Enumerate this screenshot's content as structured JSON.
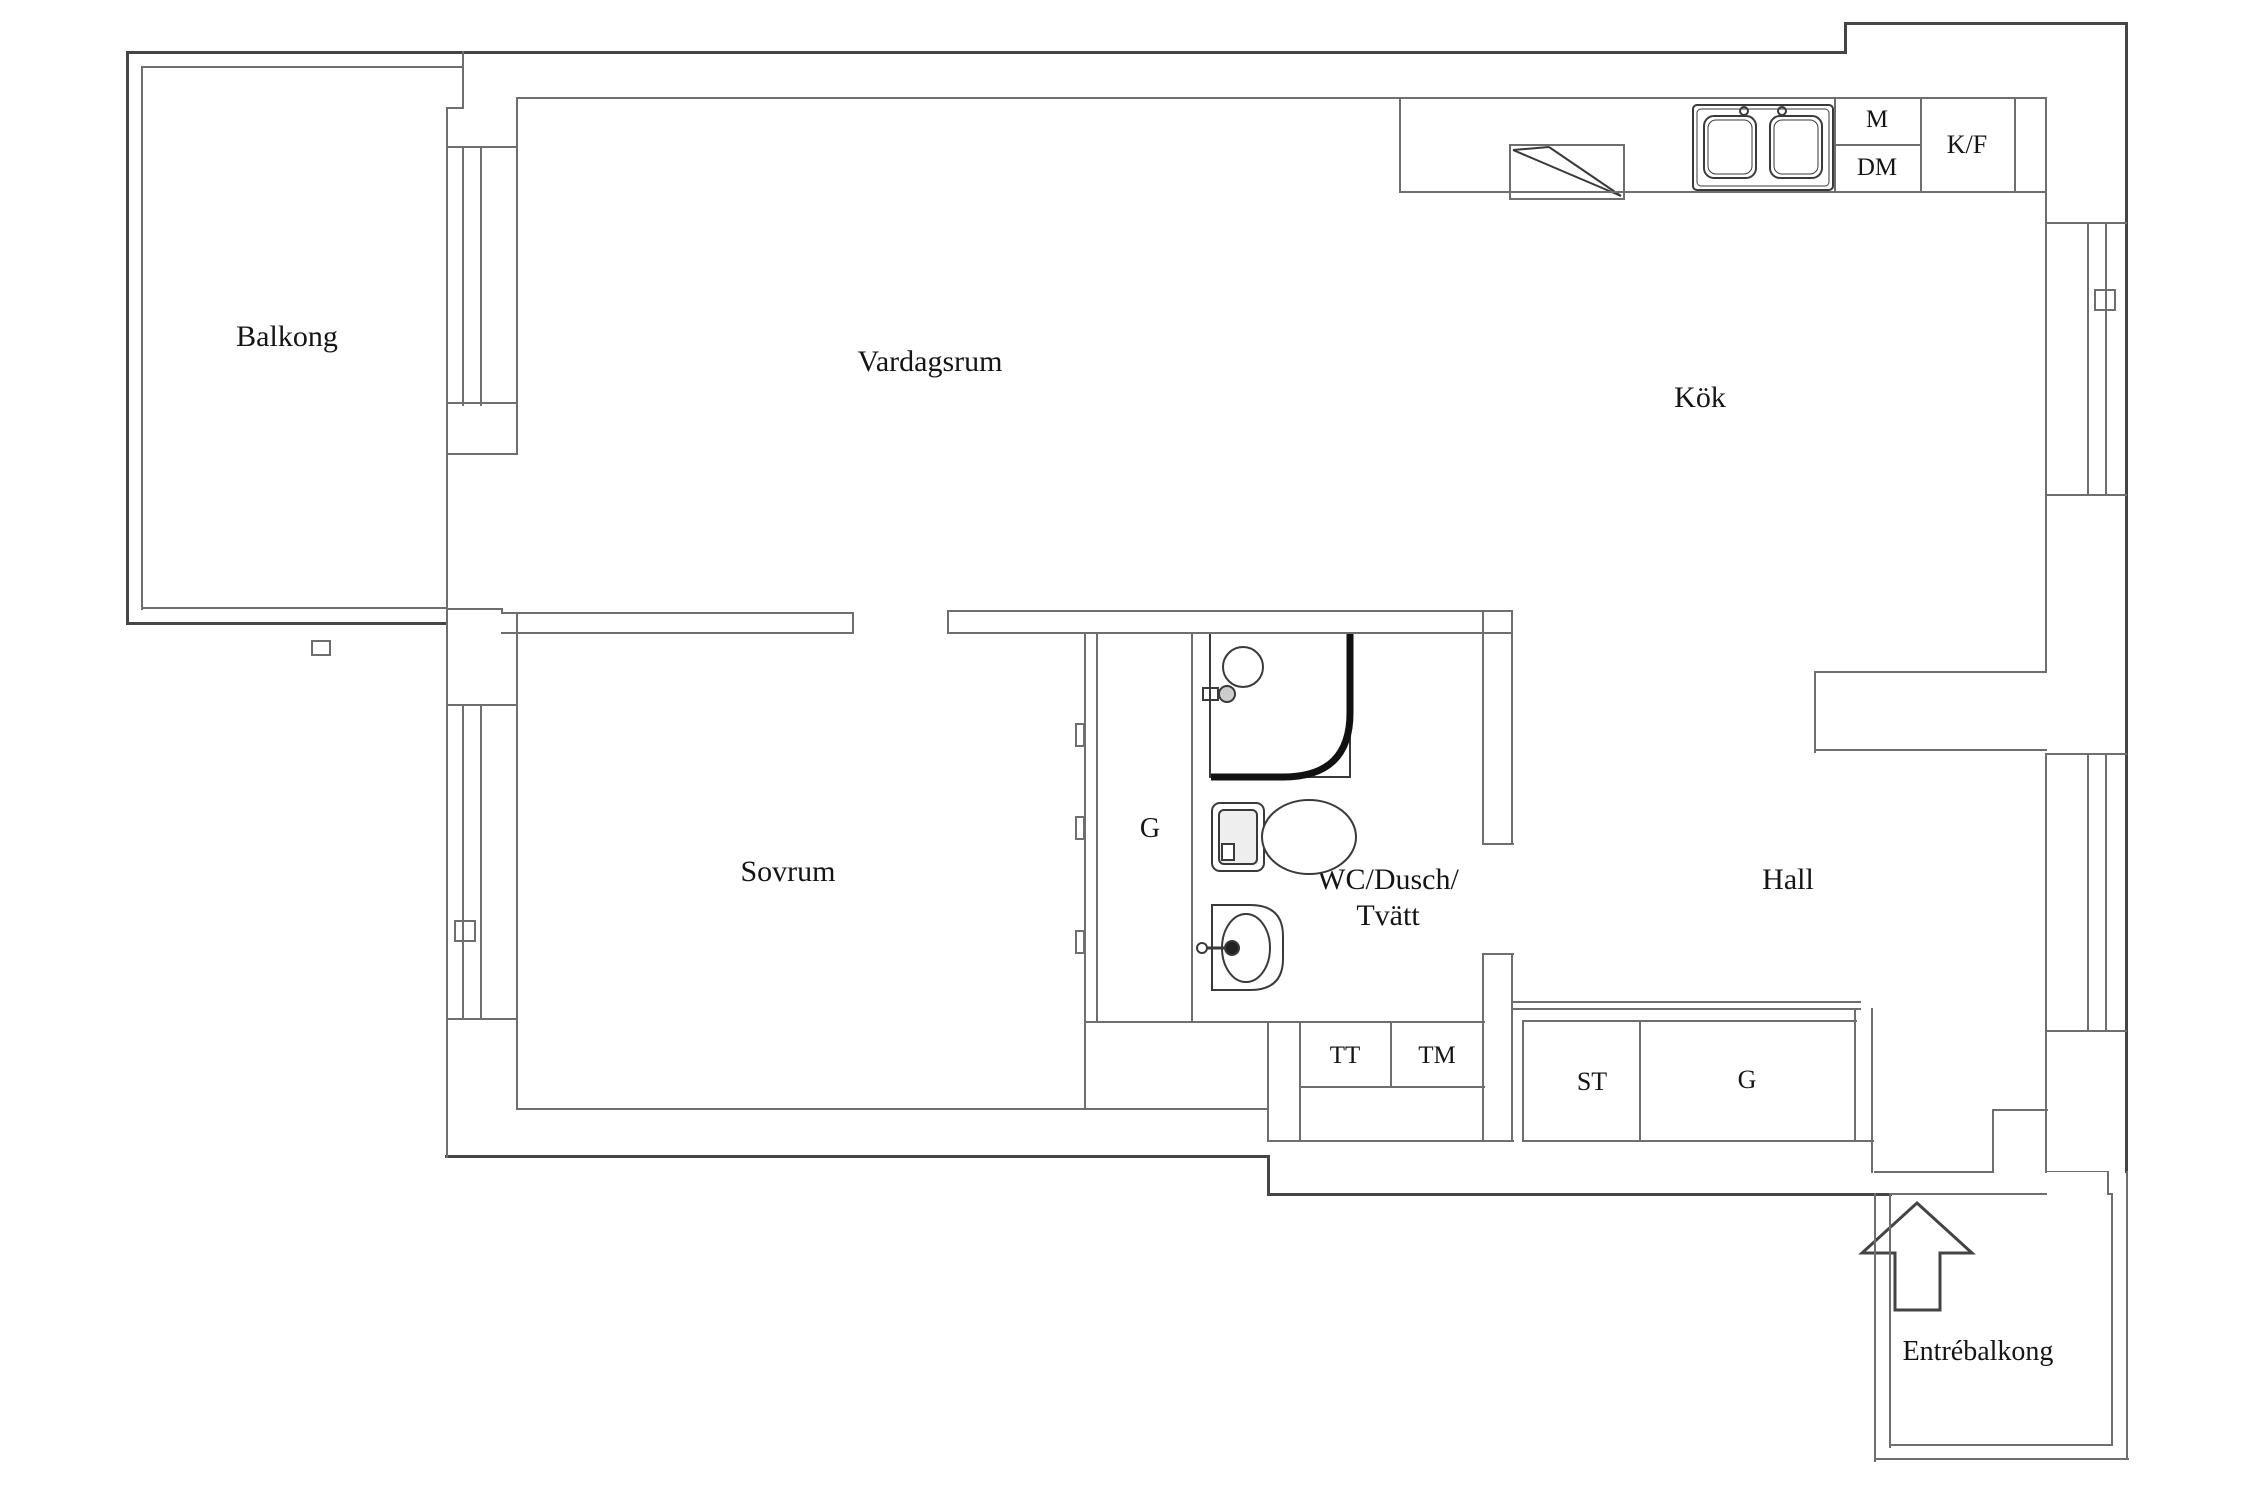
{
  "colors": {
    "background": "#ffffff",
    "wall": "#6e6e6e",
    "wall_dark": "#454545",
    "fixture": "#3a3a3a",
    "text": "#151515"
  },
  "rooms": {
    "balcony": {
      "label": "Balkong"
    },
    "living_room": {
      "label": "Vardagsrum"
    },
    "kitchen": {
      "label": "Kök"
    },
    "bedroom": {
      "label": "Sovrum"
    },
    "hall": {
      "label": "Hall"
    },
    "bathroom": {
      "label_line1": "WC/Dusch/",
      "label_line2": "Tvätt"
    },
    "entry_balcony": {
      "label": "Entrébalkong"
    }
  },
  "closets": {
    "bedroom_wardrobe": {
      "label": "G"
    },
    "drying_cabinet": {
      "label": "TT"
    },
    "washing_machine": {
      "label": "TM"
    },
    "cleaning_closet": {
      "label": "ST"
    },
    "hall_wardrobe": {
      "label": "G"
    }
  },
  "kitchen_appliances": {
    "microwave": {
      "label": "M"
    },
    "dishwasher": {
      "label": "DM"
    },
    "fridge_freezer": {
      "label": "K/F"
    }
  }
}
